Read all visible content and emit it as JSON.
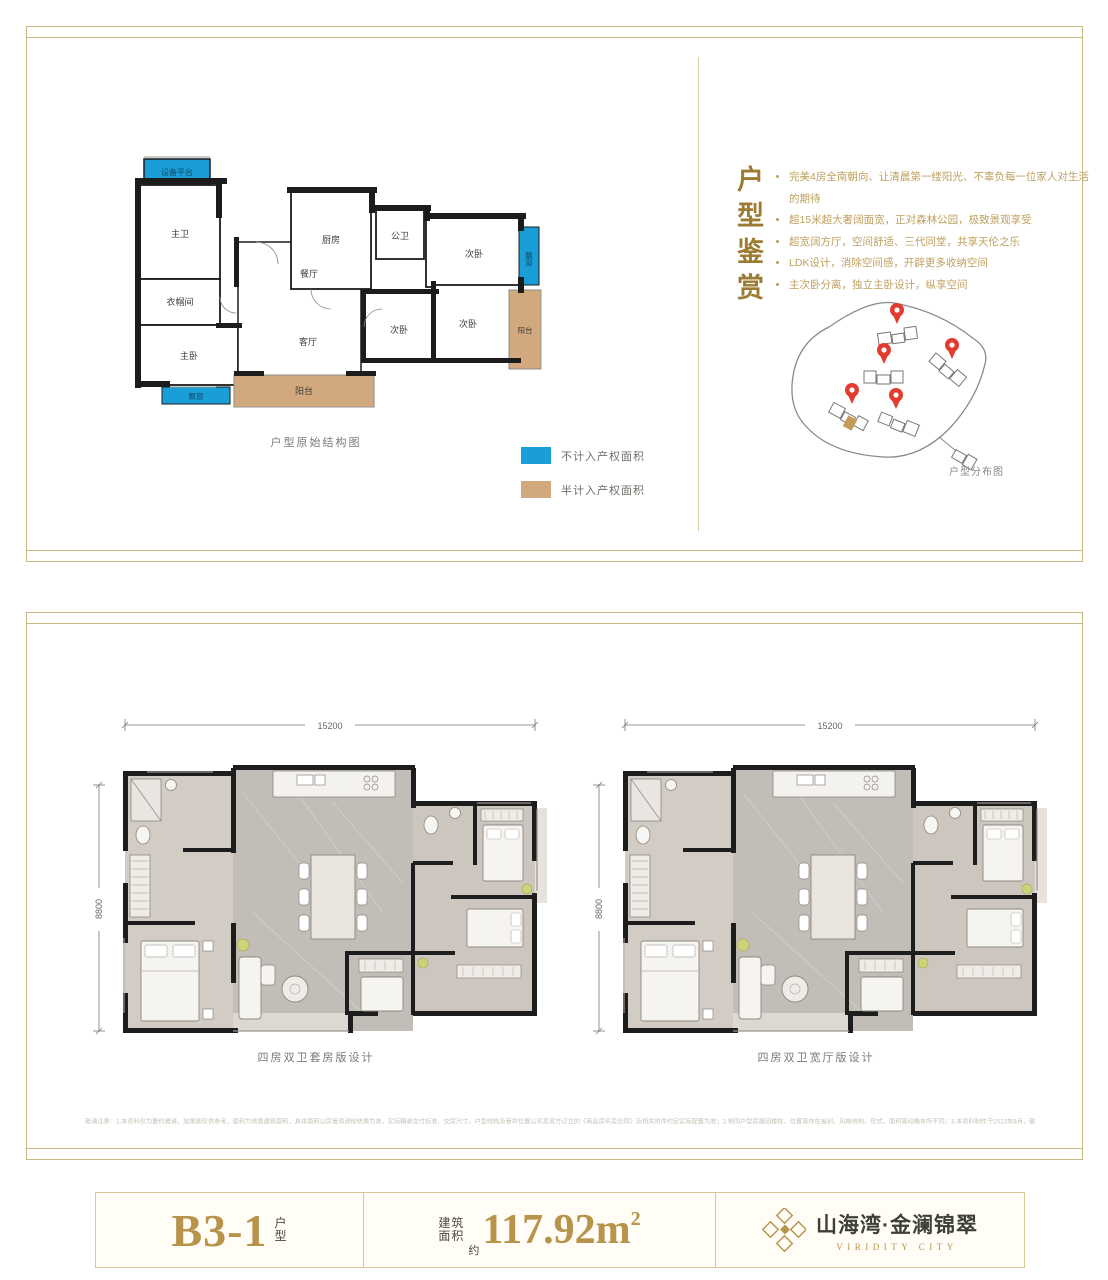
{
  "colors": {
    "accent_gold": "#b8934a",
    "border_gold": "#c9b784",
    "blue": "#1a9ed8",
    "tan": "#d2a97e",
    "pin_red": "#e23b30",
    "wall_black": "#1c1c1c"
  },
  "top_panel": {
    "structural_plan": {
      "caption": "户型原始结构图",
      "rooms": {
        "equip": "设备平台",
        "master_bath": "主卫",
        "cloak": "衣帽间",
        "master_bed": "主卧",
        "kitchen": "厨房",
        "dining": "餐厅",
        "living": "客厅",
        "public_bath": "公卫",
        "bed2": "次卧",
        "bed3": "次卧",
        "bed4": "次卧",
        "balcony_side": "阳台",
        "balcony_main": "阳台",
        "bay_window_side": "飘窗",
        "bay_window_bottom": "飘窗"
      }
    },
    "legend": [
      {
        "label": "不计入产权面积",
        "color": "#1a9ed8"
      },
      {
        "label": "半计入产权面积",
        "color": "#d2a97e"
      }
    ],
    "appreciation": {
      "title": "户型鉴赏",
      "bullets": [
        "完美4房全南朝向、让清晨第一缕阳光、不辜负每一位家人对生活的期待",
        "超15米超大奢阔面宽，正对森林公园，极致景观享受",
        "超宽阔方厅，空间舒适、三代同堂，共享天伦之乐",
        "LDK设计，消除空间感，开辟更多收纳空间",
        "主次卧分离，独立主卧设计，纵享空间"
      ]
    },
    "site_plan": {
      "caption": "户型分布图",
      "pin_count": 5
    }
  },
  "bottom_panel": {
    "plans": [
      {
        "caption": "四房双卫套房版设计",
        "width_dim": "15200",
        "height_dim": "8800"
      },
      {
        "caption": "四房双卫宽厅版设计",
        "width_dim": "15200",
        "height_dim": "8800"
      }
    ],
    "disclaimer": "敬请注意：1.本资料仅为要约邀请，效果图仅供参考，面积为预售建筑面积，具体面积以房管局测绘结果为准，实际精装交付标准、交房尺寸、户型结构及管井位置以买卖双方订立的《商品房买卖合同》及相关附件约定实际配置为准；2.相同户型房屋因楼栋、位置等存在差别，风格结构、形式、面积等均略有所不同；3.本资料制作于2023年8月，敬请留意最新资料。"
  },
  "footer": {
    "unit_code": "B3-1",
    "unit_label_1": "户",
    "unit_label_2": "型",
    "area_label_1": "建筑",
    "area_label_2": "面积",
    "area_approx": "约",
    "area_value": "117.92m",
    "area_sup": "2",
    "brand_cn": "山海湾·金澜锦翠",
    "brand_en": "VIRIDITY CITY"
  }
}
